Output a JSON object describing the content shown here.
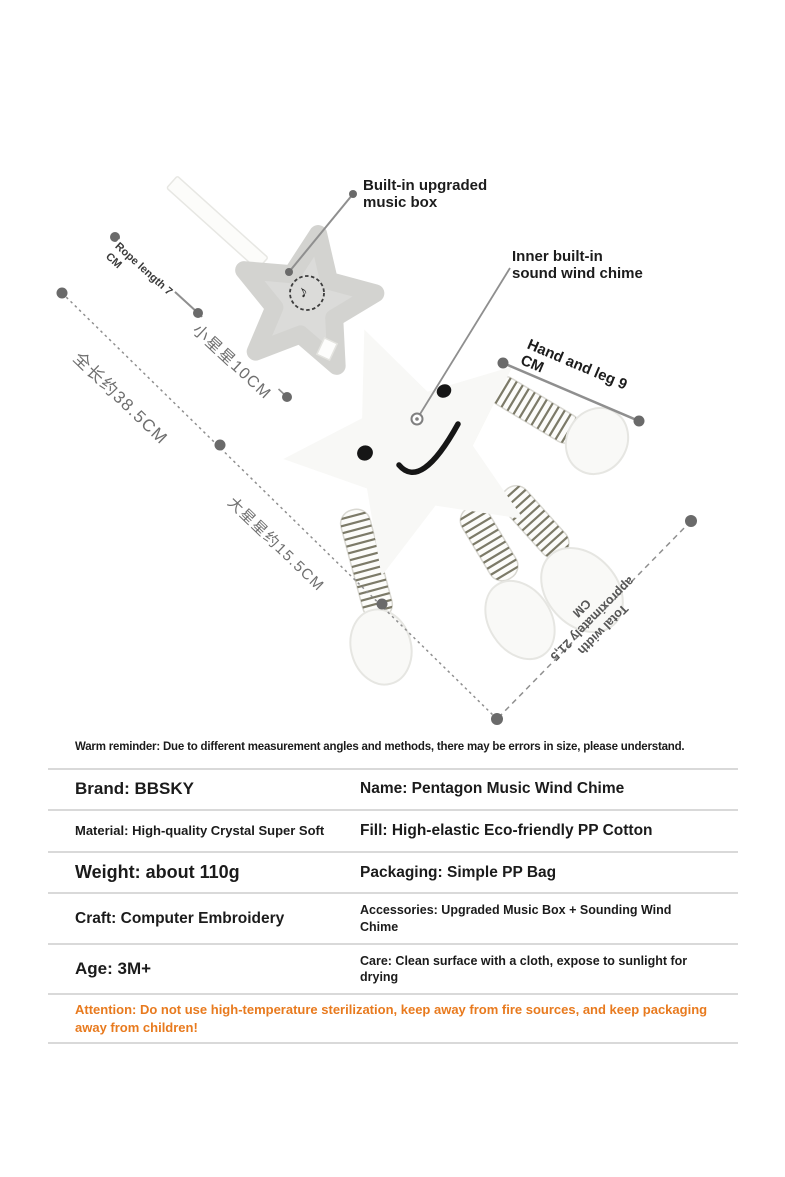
{
  "diagram": {
    "callout_music_box": {
      "line1": "Built-in upgraded",
      "line2": "music box"
    },
    "callout_wind_chime": {
      "line1": "Inner built-in",
      "line2": "sound wind chime"
    },
    "rope_label": {
      "line1": "Rope length 7",
      "line2": "CM"
    },
    "small_star_label": "小星星10CM",
    "total_length_label": "全长约38.5CM",
    "big_star_label": "大星星约15.5CM",
    "hand_leg_label": {
      "line1": "Hand and leg 9",
      "line2": "CM"
    },
    "total_width_label": {
      "line1": "Total width",
      "line2": "approximately 21,5",
      "line3": "CM"
    },
    "music_note_glyph": "♪"
  },
  "reminder": "Warm reminder: Due to different measurement angles and methods, there may be errors in size, please understand.",
  "spec_table": {
    "rows": [
      {
        "left": "Brand: BBSKY",
        "right": "Name: Pentagon Music Wind Chime"
      },
      {
        "left": "Material: High-quality Crystal Super Soft",
        "right": "Fill: High-elastic Eco-friendly PP Cotton"
      },
      {
        "left": "Weight: about 110g",
        "right": "Packaging: Simple PP Bag"
      },
      {
        "left": "Craft: Computer Embroidery",
        "right": "Accessories: Upgraded Music Box + Sounding Wind Chime"
      },
      {
        "left": "Age: 3M+",
        "right": "Care: Clean surface with a cloth, expose to sunlight for drying"
      }
    ],
    "attention": "Attention: Do not use high-temperature sterilization, keep away from fire sources, and keep packaging away from children!"
  },
  "colors": {
    "attention_orange": "#e87a1e",
    "line_gray": "#8f8f8f",
    "dot_gray": "#6a6a6a",
    "divider_gray": "#d9d9d9",
    "small_star_gray": "#dbdbd9",
    "big_star_white": "#f8f8f6",
    "stripe_olive": "#7c7a68"
  }
}
